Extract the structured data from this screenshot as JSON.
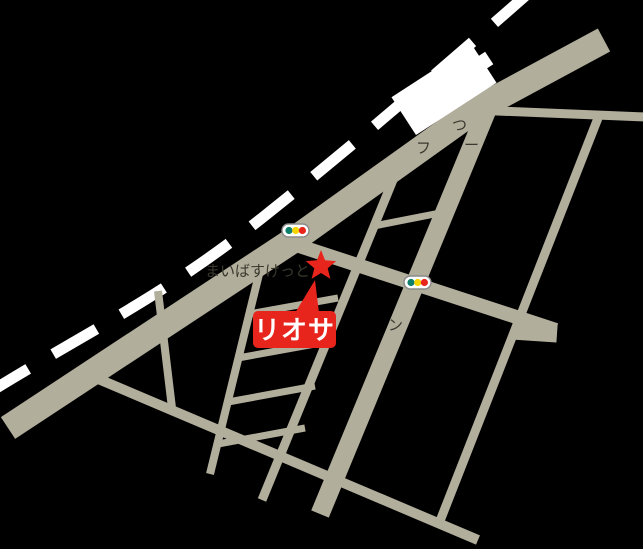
{
  "map": {
    "type": "access-map",
    "background_color": "#000000",
    "road_color": "#b2ae9c",
    "railway_color": "#ffffff",
    "station_color": "#ffffff",
    "accent_red": "#e8251c",
    "dark_text_color": "#3a392e",
    "labels": {
      "destination": "リオサ",
      "store_name": "まいばすけっと",
      "obscured_fragment_tsu": "つ",
      "obscured_fragment_fu": "フ",
      "obscured_fragment_dash": "ー",
      "obscured_fragment_n": "ン"
    },
    "markers": {
      "destination_marker": "red-star",
      "traffic_light_count": 2,
      "traffic_light_colors": {
        "green": "#0f7f6d",
        "yellow": "#f5d600",
        "red": "#e8251c"
      }
    }
  }
}
